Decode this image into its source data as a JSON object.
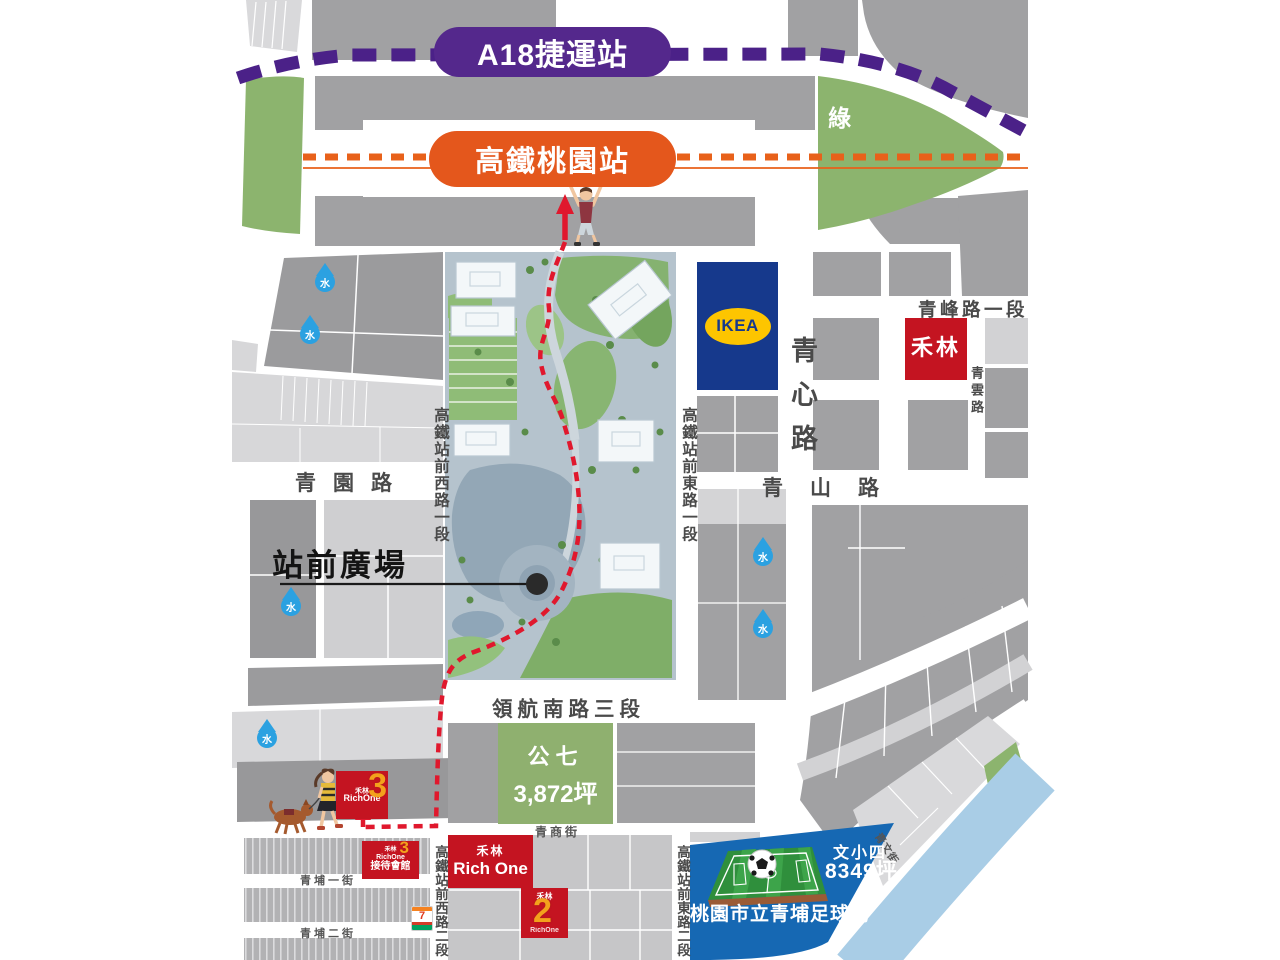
{
  "stations": {
    "mrt": "A18捷運站",
    "hsr": "高鐵桃園站"
  },
  "labels": {
    "green": "綠",
    "water": "水",
    "plaza": "站前廣場"
  },
  "zones": {
    "park7_name": "公七",
    "park7_area": "3,872坪",
    "school_name": "文小四",
    "school_area": "8349坪",
    "stadium": "桃園市立青埔足球場"
  },
  "roads": {
    "qingyuan": "青園路",
    "hsr_west_1": "高鐵站前西路一段",
    "hsr_east_1": "高鐵站前東路一段",
    "qingxin": "青心路",
    "qingfeng_1": "青峰路一段",
    "qingyun": "青雲路",
    "qingshan": "青山路",
    "linghang_south_3": "領航南路三段",
    "qingshang": "青商街",
    "qingpu_1": "青埔一街",
    "qingpu_2": "青埔二街",
    "hsr_west_2": "高鐵站前西路二段",
    "hsr_east_2": "高鐵站前東路二段",
    "qingwen": "青文街"
  },
  "landmarks": {
    "ikea": "IKEA",
    "holin": "禾林",
    "rich_one": "Rich One",
    "rich_one_compact": "RichOne",
    "num3": "3",
    "num2": "2",
    "reception": "接待會館",
    "seven": "7"
  },
  "colors": {
    "mrt_purple": "#54288c",
    "hsr_orange": "#e4571c",
    "landmark_red": "#c41421",
    "route_red": "#e0182d",
    "ikea_blue": "#16398c",
    "ikea_yellow": "#fdc500",
    "green_area": "#8cb46e",
    "park7_green": "#8fb06f",
    "water_blue": "#2ba1e1",
    "stadium_blue": "#1668b3",
    "river_blue": "#a9cde6",
    "block_gray": "#a1a1a3"
  }
}
